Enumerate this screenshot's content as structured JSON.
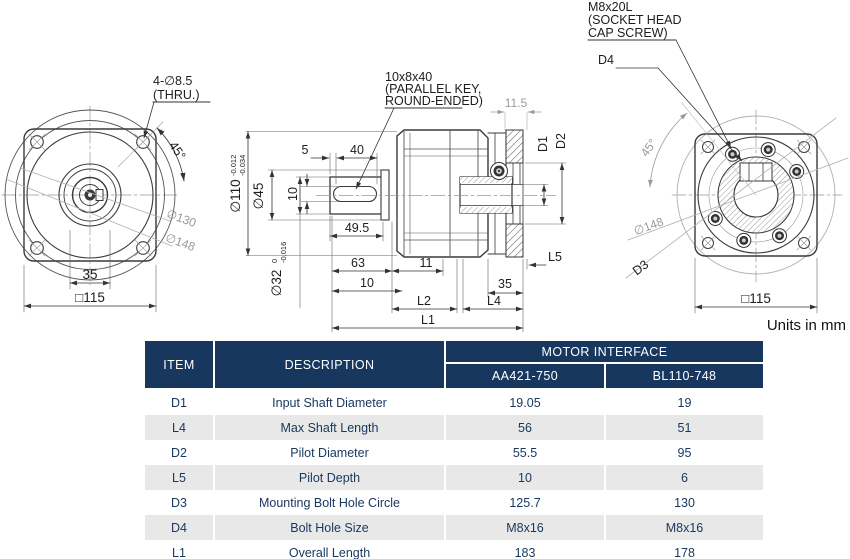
{
  "colors": {
    "table_header_bg": "#17375E",
    "table_alt_row_bg": "#E8E8E8",
    "table_text": "#17375E",
    "drawing_line": "#3a3a3a",
    "reference_gray": "#999999"
  },
  "drawing": {
    "front_view": {
      "note_line1": "4-∅8.5",
      "note_line2": "(THRU.)",
      "angle_45": "45°",
      "dia_130": "∅130",
      "dia_148": "∅148",
      "dim_35": "35",
      "dim_square_115": "□115"
    },
    "section_view": {
      "key_note_line1": "10x8x40",
      "key_note_line2": "(PARALLEL KEY,",
      "key_note_line3": "ROUND-ENDED)",
      "dim_5": "5",
      "dim_40": "40",
      "dim_11_5": "11.5",
      "dia_110": "∅110",
      "dia_110_tol_up": "-0.012",
      "dia_110_tol_low": "-0.034",
      "dia_45": "∅45",
      "dim_10_key": "10",
      "dia_32": "∅32",
      "dia_32_tol_up": "0",
      "dia_32_tol_low": "-0.016",
      "dim_49_5": "49.5",
      "dim_63": "63",
      "dim_11": "11",
      "dim_10": "10",
      "dim_35": "35",
      "label_d1": "D1",
      "label_d2": "D2",
      "label_l2": "L2",
      "label_l4": "L4",
      "label_l5": "L5",
      "label_l1": "L1"
    },
    "rear_view": {
      "screw_note_line1": "M8x20L",
      "screw_note_line2": "(SOCKET HEAD",
      "screw_note_line3": "CAP SCREW)",
      "label_d4": "D4",
      "label_d3": "D3",
      "angle_45": "45°",
      "dia_148": "∅148",
      "dim_square_115": "□115"
    },
    "units_note": "Units in mm"
  },
  "table": {
    "headers": {
      "item": "ITEM",
      "description": "DESCRIPTION",
      "motor_interface": "MOTOR INTERFACE",
      "col1": "AA421-750",
      "col2": "BL110-748"
    },
    "rows": [
      {
        "item": "D1",
        "description": "Input Shaft Diameter",
        "aa421_750": "19.05",
        "bl110_748": "19"
      },
      {
        "item": "L4",
        "description": "Max Shaft Length",
        "aa421_750": "56",
        "bl110_748": "51"
      },
      {
        "item": "D2",
        "description": "Pilot Diameter",
        "aa421_750": "55.5",
        "bl110_748": "95"
      },
      {
        "item": "L5",
        "description": "Pilot Depth",
        "aa421_750": "10",
        "bl110_748": "6"
      },
      {
        "item": "D3",
        "description": "Mounting Bolt Hole Circle",
        "aa421_750": "125.7",
        "bl110_748": "130"
      },
      {
        "item": "D4",
        "description": "Bolt Hole Size",
        "aa421_750": "M8x16",
        "bl110_748": "M8x16"
      },
      {
        "item": "L1",
        "description": "Overall Length",
        "aa421_750": "183",
        "bl110_748": "178"
      }
    ]
  }
}
